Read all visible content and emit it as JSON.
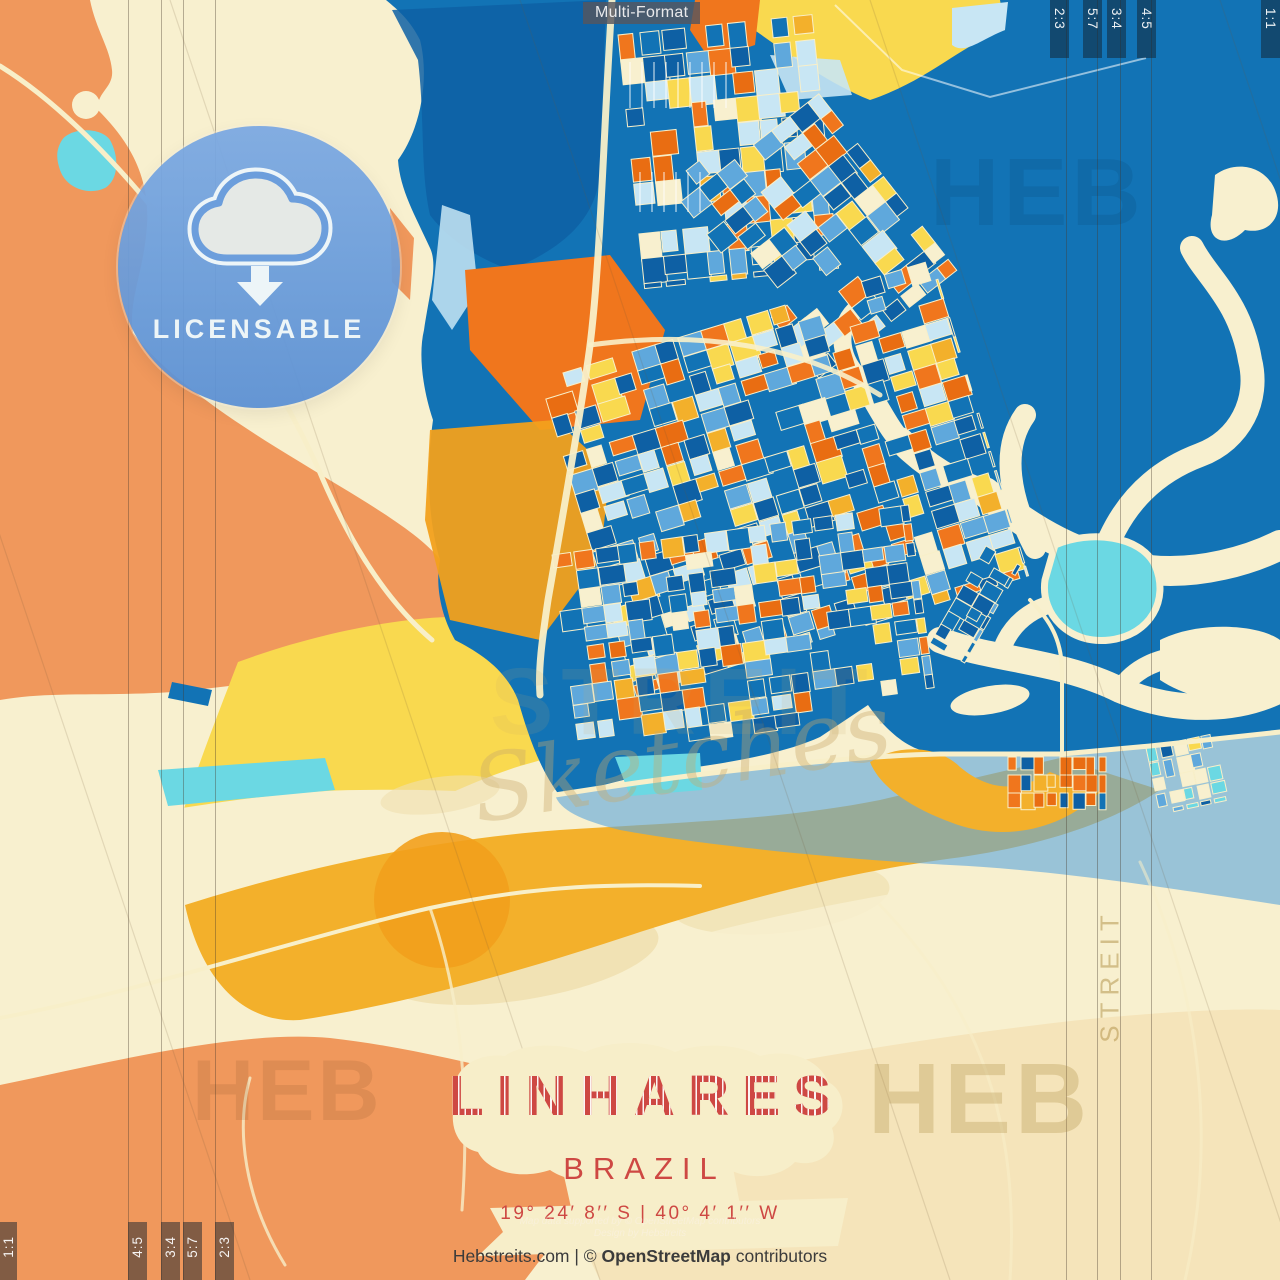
{
  "product": {
    "format_chip": "Multi-Format",
    "badge": {
      "label": "LICENSABLE",
      "icon": "cloud-download-icon"
    },
    "title": {
      "city": "LINHARES",
      "country": "BRAZIL",
      "coordinates": "19° 24′ 8′′ S | 40° 4′ 1′′ W"
    },
    "crop_formats": {
      "top_right": [
        "2:3",
        "5:7",
        "3:4",
        "4:5",
        "1:1"
      ],
      "bottom_left": [
        "1:1",
        "4:5",
        "3:4",
        "5:7",
        "2:3"
      ]
    },
    "watermarks": {
      "brand_short": "HEB",
      "brand_mid": "STREIT",
      "brand_script": "Sketches"
    },
    "footer": {
      "fine_print_line1": "Map data supported by © OpenStreetMap contributors",
      "fine_print_line2": "Design by Hebstreits",
      "credit_site": "Hebstreits.com",
      "credit_separator": " | © ",
      "credit_org": "OpenStreetMap",
      "credit_suffix": " contributors"
    },
    "palette": {
      "creamLand": "#F8F0CF",
      "tanSand": "#F0DFAF",
      "tanBottom": "#F5E4BA",
      "orangeLand": "#F0985C",
      "orangeBlock": "#F0761D",
      "orangeDeep": "#E96D12",
      "blueWater": "#1273B5",
      "blueDeep": "#0E60A4",
      "blueLight": "#5FA8DC",
      "bluePale": "#C8E6F4",
      "cyan": "#6BD8E3",
      "yellowBright": "#F9D94F",
      "goldBand": "#F3B02B",
      "goldDeep": "#F2A01C",
      "roadCream": "#F8EFC9",
      "titleRed": "#CE4843",
      "badgeBlue": "#6C9EDC"
    }
  }
}
